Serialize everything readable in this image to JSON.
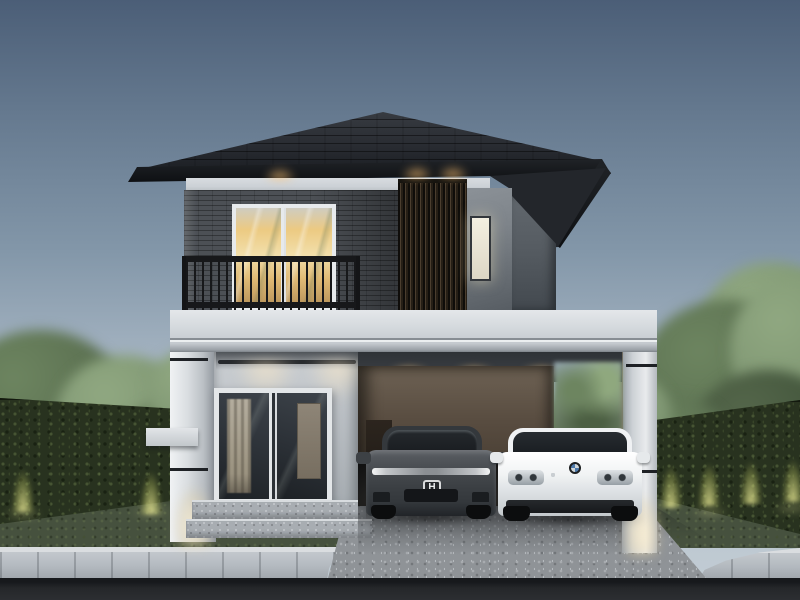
{
  "scene": {
    "description": "Dusk architectural 3D rendering of a modern two-storey house with dark hipped roof, balcony, wood louver screen, white concrete fascia band and an open double carport with two parked sedans",
    "time_of_day": "dusk"
  },
  "palette": {
    "sky_top": "#4b5e77",
    "sky_mid": "#8397a9",
    "sky_low": "#b7c3cd",
    "roof_tile": "#26292e",
    "roof_fascia": "#141619",
    "band_white": "#ccd1d6",
    "brick": "#4c5055",
    "louver_dark": "#2e2822",
    "louver_glow": "#d8a55c",
    "panel_gray": "#7e848a",
    "wing_gray": "#565c62",
    "door_glass_warm": "#ecca82",
    "railing_black": "#17181a",
    "slab": "#d3d8dc",
    "column": "#d4d8dc",
    "wall": "#bcc1c6",
    "window_glass": "#2c3136",
    "curtain": "#b4ad9e",
    "steps": "#a8adb2",
    "carport_wall": "#584c40",
    "ceiling": "#3a3e44",
    "hedge": "#28321f",
    "hedge_glow": "#8c9a50",
    "grass": "#46513e",
    "tree_dark": "#3f5239",
    "tree_light": "#7d9471",
    "sidewalk": "#b4bac0",
    "curb": "#dadde0",
    "road": "#25272a",
    "driveway": "#8f9397",
    "honda_body": "#44484c",
    "bmw_body": "#f1f3f4",
    "glow_warm": "#ffc27d"
  },
  "objects": {
    "house": {
      "label": "modern two-storey house"
    },
    "roof": {
      "label": "dark hipped tile roof with downlights"
    },
    "upper_floor": {
      "label": "second storey with dark brick cladding"
    },
    "balcony": {
      "label": "balcony with black metal railing"
    },
    "balcony_door": {
      "label": "sliding glass door with warm interior light"
    },
    "louver_screen": {
      "label": "vertical wood louver screen, backlit"
    },
    "small_window": {
      "label": "small frosted lit window"
    },
    "slab_band": {
      "label": "white concrete fascia band over carport"
    },
    "lower_floor": {
      "label": "ground floor with large sliding window"
    },
    "window": {
      "label": "ground floor sliding glass window with curtain"
    },
    "carport": {
      "label": "open double carport"
    },
    "cars": {
      "honda": {
        "label": "dark grey Honda sedan",
        "badge_letter": "H"
      },
      "bmw": {
        "label": "white BMW sedan"
      }
    },
    "landscape": {
      "hedge_left": {
        "label": "ivy-covered fence wall with uplights"
      },
      "hedge_right": {
        "label": "ivy-covered fence wall with uplights"
      },
      "trees": {
        "label": "green garden trees"
      },
      "lawn": {
        "label": "front lawn"
      },
      "driveway": {
        "label": "aggregate concrete driveway"
      },
      "sidewalk": {
        "label": "paved sidewalk with white curb"
      },
      "road": {
        "label": "asphalt road"
      }
    }
  }
}
